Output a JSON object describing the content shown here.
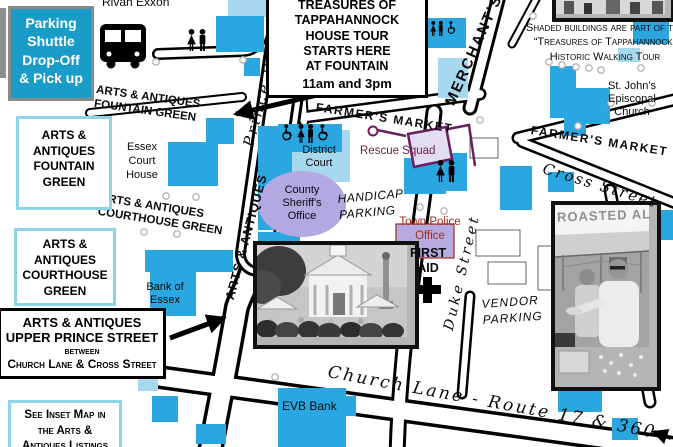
{
  "colors": {
    "building_blue": "#2AA7E0",
    "building_light_blue": "#A8D8F0",
    "building_shaded_lavender": "#B7AADE",
    "parking_box_teal": "#1A9CC8",
    "legend_box_border_blue": "#8FD4E6",
    "walking_tour_route_purple": "#6B1F5E",
    "rescue_squad_text": "#6B2346",
    "town_police_text": "#9C2B1A"
  },
  "legend": {
    "parking_shuttle": "Parking\nShuttle\nDrop-Off\n& Pick up",
    "house_tour": {
      "title": "TREASURES OF\nTAPPAHANNOCK\nHOUSE TOUR\nSTARTS HERE\nAT FOUNTAIN",
      "times": "11am and 3pm"
    },
    "shaded_note": "Shaded buildings are part of the\n“Treasures of Tappahannock”\nHistoric Walking Tour",
    "fountain_green_box": "ARTS &\nANTIQUES\nFOUNTAIN\nGREEN",
    "courthouse_green_box": "ARTS &\nANTIQUES\nCOURTHOUSE\nGREEN",
    "upper_prince_box": {
      "line1": "ARTS &  ANTIQUES",
      "line2": "UPPER PRINCE STREET",
      "line3": "between",
      "line4": "Church Lane & Cross Street"
    },
    "inset_note": "See Inset Map in\nthe Arts &\nAntiques Listings"
  },
  "streets": {
    "prince": "Prince Street",
    "prince_route_label": "ARTS & ANTIQUES",
    "prince_upper_cut": "AR",
    "merchants": "MERCHANT'S",
    "farmers_market_west": "FARMER'S MARKET",
    "farmers_market_east": "FARMER'S MARKET",
    "cross": "Cross Street",
    "duke": "Duke Street",
    "church_lane": "Church Lane - Route 17 & 360"
  },
  "places": {
    "rivah_exxon": "Rivah Exxon",
    "fountain_green_map": "ARTS &  ANTIQUES\nFOUNTAIN GREEN",
    "courthouse_green_map": "ARTS &  ANTIQUES\nCOURTHOUSE GREEN",
    "essex_court_house": "Essex\nCourt\nHouse",
    "bank_of_essex": "Bank of\nEssex",
    "district_court": "District\nCourt",
    "rescue_squad": "Rescue Squad",
    "county_sheriff": "County\nSheriff's\nOffice",
    "handicap_parking": "HANDICAP\nPARKING",
    "town_police": "Town Police\nOffice",
    "first_aid": "FIRST\nAID",
    "vendor_parking": "VENDOR\nPARKING",
    "st_johns": "St. John's\nEpiscopal\nChurch",
    "evb_bank": "EVB Bank"
  },
  "photos": {
    "roasted_sign": "ROASTED AL"
  }
}
